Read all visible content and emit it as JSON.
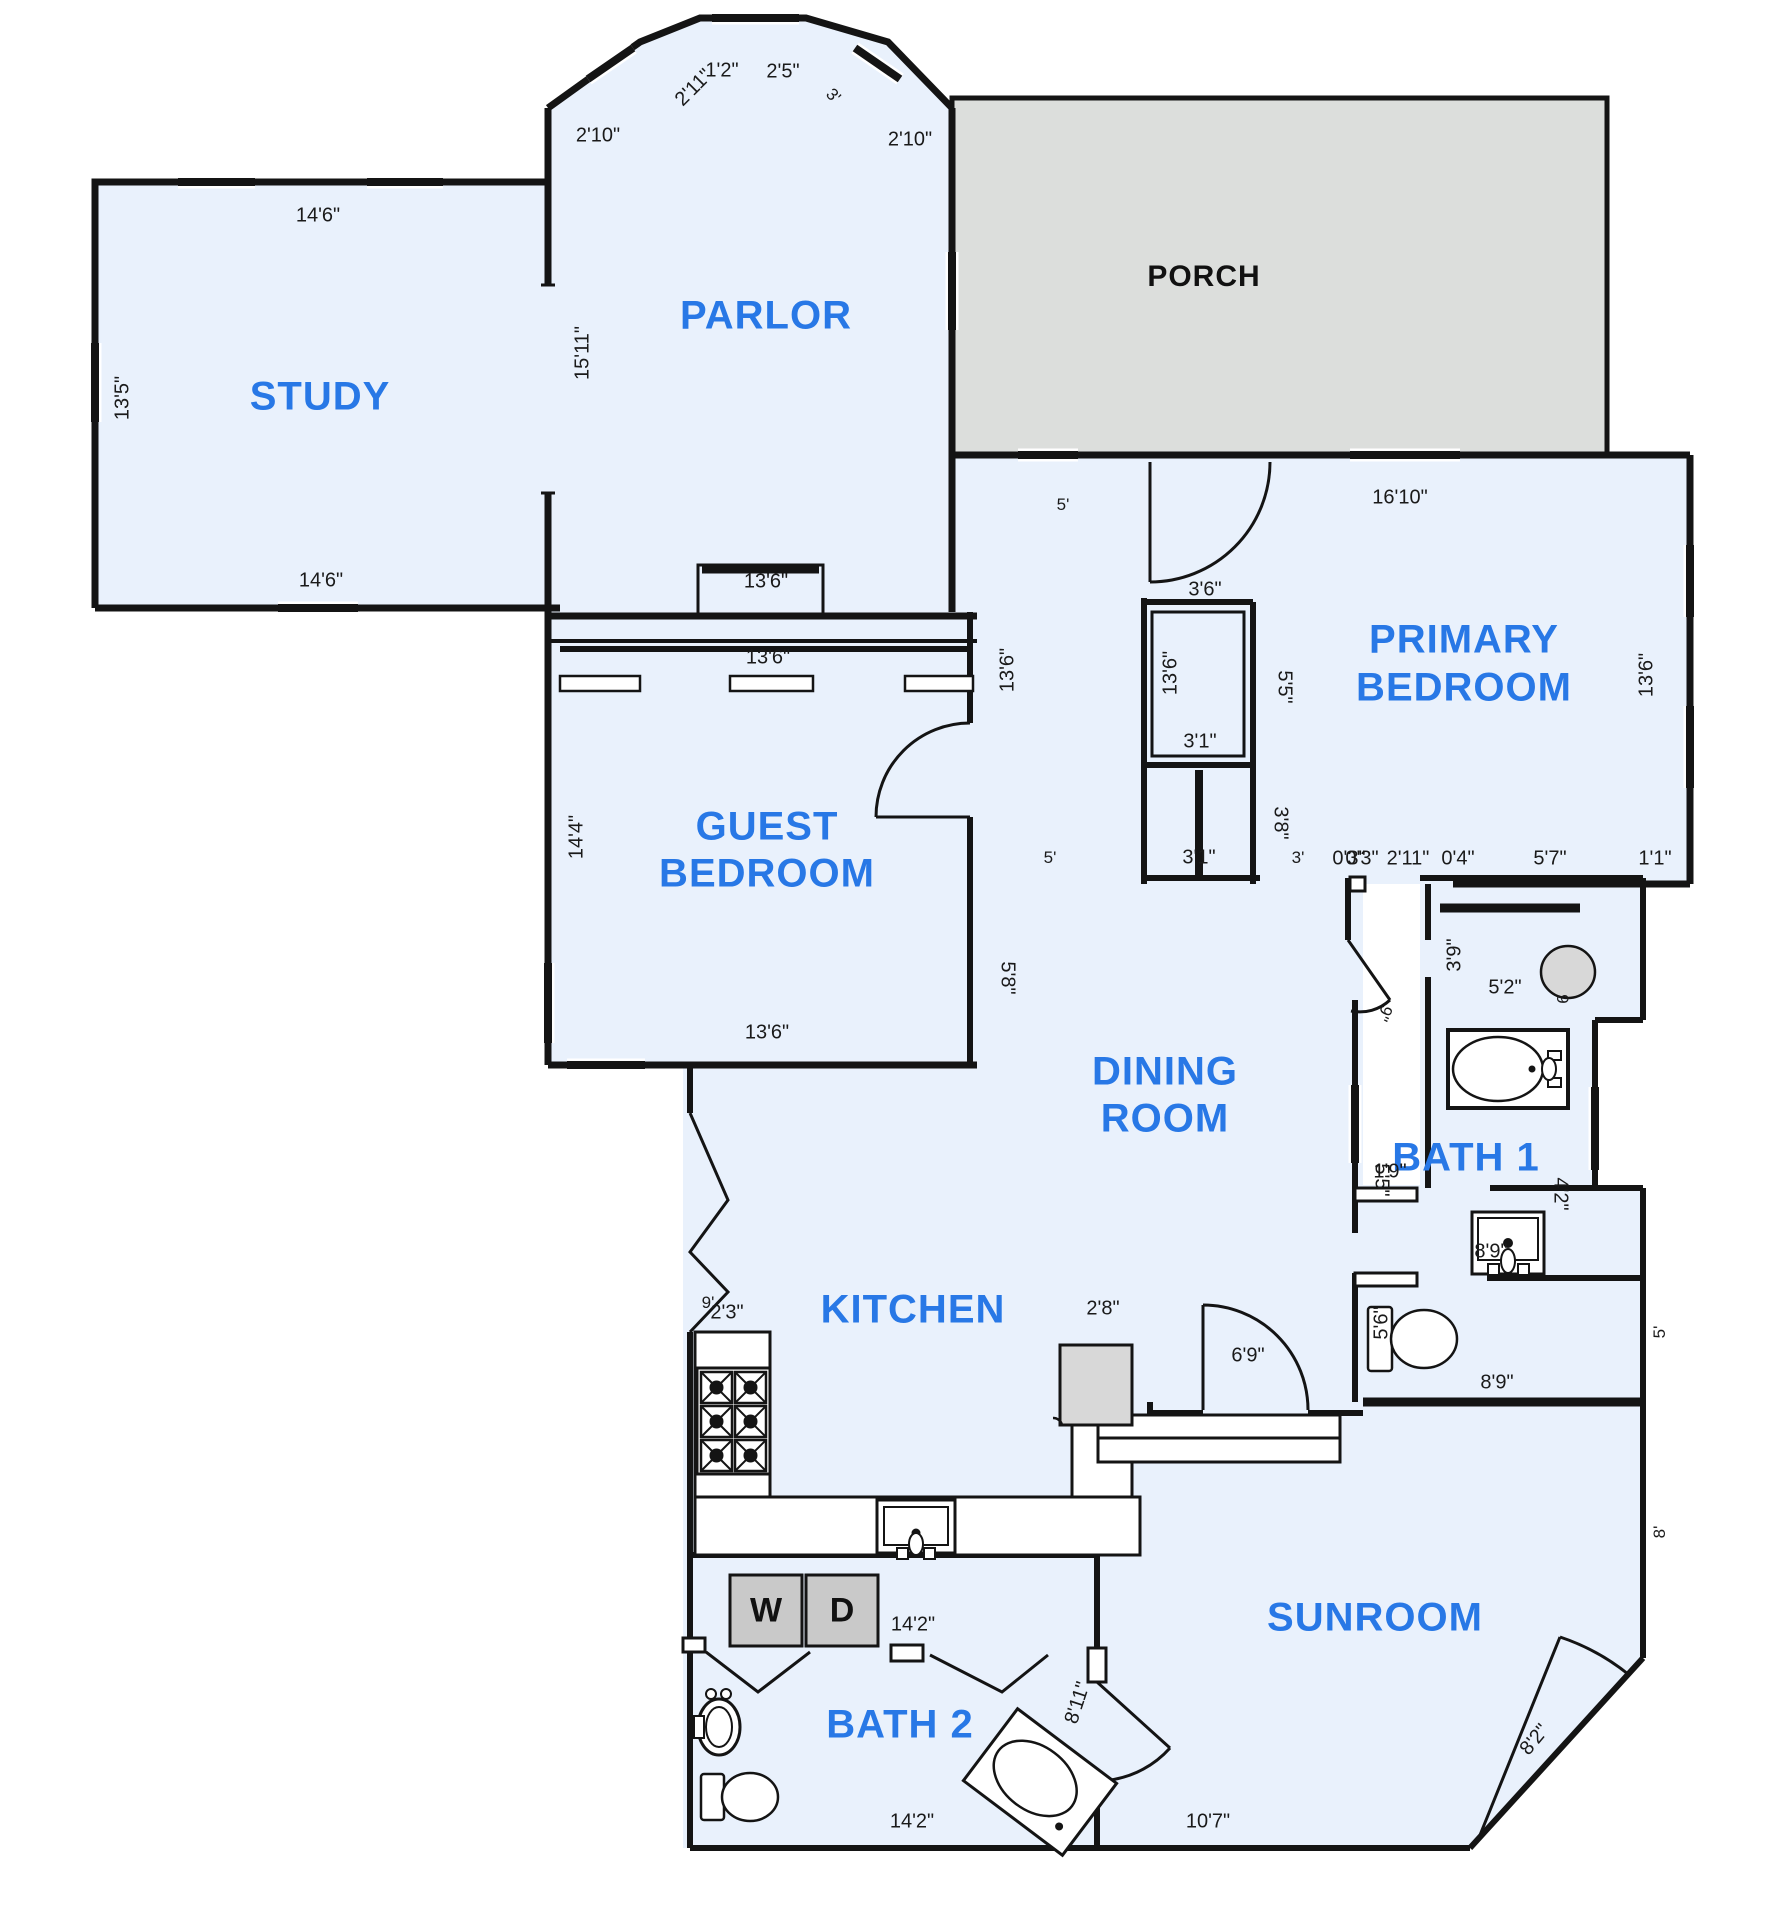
{
  "canvas": {
    "width": 1766,
    "height": 1920,
    "background": "#ffffff"
  },
  "colors": {
    "floor_fill": "#e9f1fc",
    "porch_fill": "#dcdedc",
    "wall": "#141414",
    "room_label": "#2878e6",
    "appliance_fill": "#c9c9c9",
    "fixture_gray": "#d8d8d8"
  },
  "room_labels": [
    {
      "id": "study",
      "text": "STUDY",
      "x": 320,
      "y": 397
    },
    {
      "id": "parlor",
      "text": "PARLOR",
      "x": 766,
      "y": 316
    },
    {
      "id": "primary-bedroom-1",
      "text": "PRIMARY",
      "x": 1464,
      "y": 640
    },
    {
      "id": "primary-bedroom-2",
      "text": "BEDROOM",
      "x": 1464,
      "y": 688
    },
    {
      "id": "guest-bedroom-1",
      "text": "GUEST",
      "x": 767,
      "y": 827
    },
    {
      "id": "guest-bedroom-2",
      "text": "BEDROOM",
      "x": 767,
      "y": 874
    },
    {
      "id": "dining-room-1",
      "text": "DINING",
      "x": 1165,
      "y": 1072
    },
    {
      "id": "dining-room-2",
      "text": "ROOM",
      "x": 1165,
      "y": 1119
    },
    {
      "id": "kitchen",
      "text": "KITCHEN",
      "x": 913,
      "y": 1310
    },
    {
      "id": "bath-1",
      "text": "BATH 1",
      "x": 1466,
      "y": 1158
    },
    {
      "id": "bath-2",
      "text": "BATH 2",
      "x": 900,
      "y": 1725
    },
    {
      "id": "sunroom",
      "text": "SUNROOM",
      "x": 1375,
      "y": 1618
    }
  ],
  "porch_label": {
    "id": "porch",
    "text": "PORCH",
    "x": 1204,
    "y": 277
  },
  "appliance_labels": [
    {
      "id": "washer",
      "text": "W",
      "x": 766,
      "y": 1611
    },
    {
      "id": "dryer",
      "text": "D",
      "x": 842,
      "y": 1611
    }
  ],
  "dimension_labels": [
    {
      "text": "2'11\"",
      "x": 694,
      "y": 88,
      "rot": -45
    },
    {
      "text": "1'2\"",
      "x": 722,
      "y": 71,
      "rot": 0
    },
    {
      "text": "2'5\"",
      "x": 783,
      "y": 72,
      "rot": 0
    },
    {
      "text": "3'",
      "x": 833,
      "y": 96,
      "rot": 45
    },
    {
      "text": "2'10\"",
      "x": 598,
      "y": 136,
      "rot": 0
    },
    {
      "text": "2'10\"",
      "x": 910,
      "y": 140,
      "rot": 0
    },
    {
      "text": "14'6\"",
      "x": 318,
      "y": 216,
      "rot": 0
    },
    {
      "text": "13'5\"",
      "x": 123,
      "y": 398,
      "rot": -90
    },
    {
      "text": "15'11\"",
      "x": 583,
      "y": 353,
      "rot": -90
    },
    {
      "text": "14'6\"",
      "x": 321,
      "y": 581,
      "rot": 0
    },
    {
      "text": "13'6\"",
      "x": 766,
      "y": 582,
      "rot": 0
    },
    {
      "text": "13'6\"",
      "x": 768,
      "y": 658,
      "rot": 0
    },
    {
      "text": "5'",
      "x": 1063,
      "y": 505,
      "rot": 0
    },
    {
      "text": "16'10\"",
      "x": 1400,
      "y": 498,
      "rot": 0
    },
    {
      "text": "3'6\"",
      "x": 1205,
      "y": 590,
      "rot": 0
    },
    {
      "text": "13'6\"",
      "x": 1008,
      "y": 670,
      "rot": -90
    },
    {
      "text": "13'6\"",
      "x": 1171,
      "y": 673,
      "rot": -90
    },
    {
      "text": "5'5\"",
      "x": 1284,
      "y": 687,
      "rot": 90
    },
    {
      "text": "3'1\"",
      "x": 1200,
      "y": 742,
      "rot": 0
    },
    {
      "text": "3'8\"",
      "x": 1280,
      "y": 823,
      "rot": 90
    },
    {
      "text": "13'6\"",
      "x": 1647,
      "y": 675,
      "rot": -90
    },
    {
      "text": "14'4\"",
      "x": 577,
      "y": 837,
      "rot": -90
    },
    {
      "text": "5'",
      "x": 1050,
      "y": 858,
      "rot": 0
    },
    {
      "text": "3'1\"",
      "x": 1199,
      "y": 858,
      "rot": 0
    },
    {
      "text": "3'",
      "x": 1298,
      "y": 858,
      "rot": 0
    },
    {
      "text": "0'3\"",
      "x": 1349,
      "y": 859,
      "rot": 0
    },
    {
      "text": "0'3\"",
      "x": 1362,
      "y": 859,
      "rot": 0
    },
    {
      "text": "2'11\"",
      "x": 1408,
      "y": 859,
      "rot": 0
    },
    {
      "text": "0'4\"",
      "x": 1458,
      "y": 859,
      "rot": 0
    },
    {
      "text": "5'7\"",
      "x": 1550,
      "y": 859,
      "rot": 0
    },
    {
      "text": "1'1\"",
      "x": 1655,
      "y": 859,
      "rot": 0
    },
    {
      "text": "13'6\"",
      "x": 767,
      "y": 1033,
      "rot": 0
    },
    {
      "text": "5'8\"",
      "x": 1007,
      "y": 978,
      "rot": 90
    },
    {
      "text": "9\"",
      "x": 1384,
      "y": 1013,
      "rot": 115
    },
    {
      "text": "3'9\"",
      "x": 1455,
      "y": 955,
      "rot": -90
    },
    {
      "text": "5'2\"",
      "x": 1505,
      "y": 988,
      "rot": 0
    },
    {
      "text": "9",
      "x": 1562,
      "y": 999,
      "rot": 90
    },
    {
      "text": "1'9\"",
      "x": 1390,
      "y": 1172,
      "rot": 0
    },
    {
      "text": "5'5\"",
      "x": 1381,
      "y": 1180,
      "rot": 90
    },
    {
      "text": "4'2\"",
      "x": 1560,
      "y": 1194,
      "rot": 90
    },
    {
      "text": "8'9\"",
      "x": 1491,
      "y": 1252,
      "rot": 0
    },
    {
      "text": "5'6\"",
      "x": 1382,
      "y": 1323,
      "rot": -90
    },
    {
      "text": "8'9\"",
      "x": 1497,
      "y": 1383,
      "rot": 0
    },
    {
      "text": "5'",
      "x": 1660,
      "y": 1332,
      "rot": -90
    },
    {
      "text": "8'",
      "x": 1660,
      "y": 1532,
      "rot": -90
    },
    {
      "text": "2'8\"",
      "x": 1103,
      "y": 1309,
      "rot": 0
    },
    {
      "text": "9'",
      "x": 708,
      "y": 1303,
      "rot": 0
    },
    {
      "text": "2'3\"",
      "x": 727,
      "y": 1313,
      "rot": 0
    },
    {
      "text": "6'9\"",
      "x": 1248,
      "y": 1356,
      "rot": 0
    },
    {
      "text": "14'2\"",
      "x": 913,
      "y": 1625,
      "rot": 0
    },
    {
      "text": "14'2\"",
      "x": 912,
      "y": 1822,
      "rot": 0
    },
    {
      "text": "8'11\"",
      "x": 1078,
      "y": 1703,
      "rot": -72
    },
    {
      "text": "8'2\"",
      "x": 1535,
      "y": 1740,
      "rot": -50
    },
    {
      "text": "10'7\"",
      "x": 1208,
      "y": 1822,
      "rot": 0
    }
  ]
}
